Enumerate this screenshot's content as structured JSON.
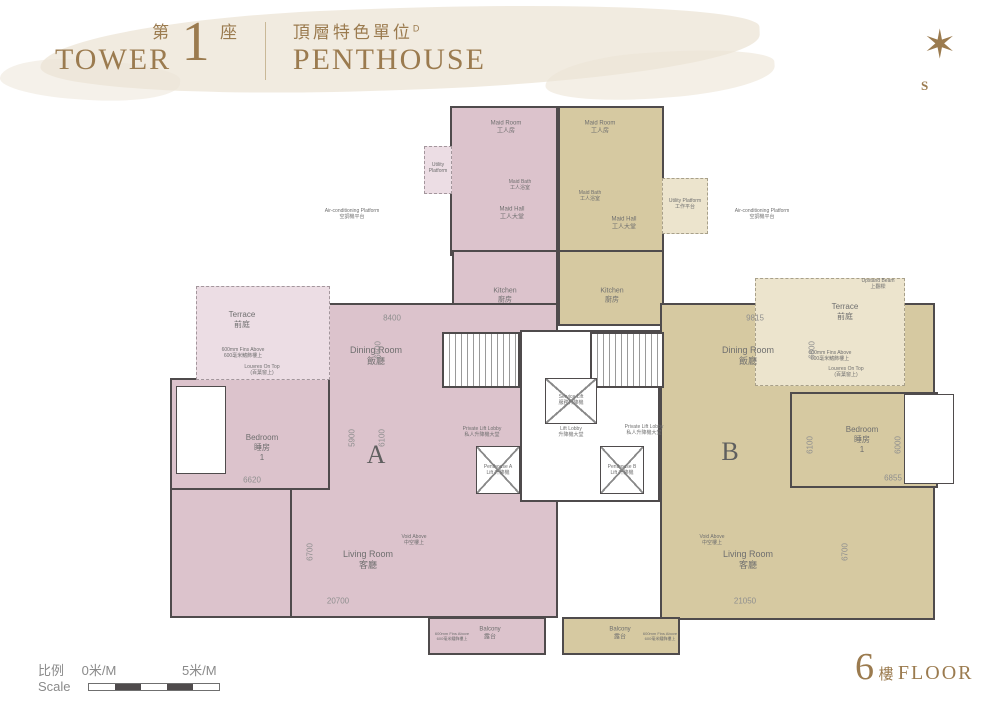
{
  "header": {
    "tower_zh_prefix": "第",
    "tower_number": "1",
    "tower_zh_suffix": "座",
    "tower_en": "TOWER",
    "unit_zh": "頂層特色單位",
    "unit_superscript": "D",
    "unit_en": "PENTHOUSE"
  },
  "compass": {
    "south_label": "S",
    "star_icon": "compass-star"
  },
  "footer": {
    "scale_zh": "比例",
    "scale_en": "Scale",
    "scale_start": "0米/M",
    "scale_end": "5米/M",
    "floor_number": "6",
    "floor_zh": "樓",
    "floor_en": "FLOOR"
  },
  "colors": {
    "accent_gold": "#9b7b4f",
    "unit_a_fill": "#dcc3cc",
    "unit_b_fill": "#d6c9a1",
    "wall": "#4f4b4c",
    "label_gray": "#6f6f6f",
    "dim_gray": "#8f8f8f"
  },
  "plan": {
    "rooms": [
      {
        "id": "unit-a-maid-block",
        "x": 450,
        "y": 106,
        "w": 108,
        "h": 150,
        "cls": "a"
      },
      {
        "id": "unit-a-utility-platform",
        "x": 424,
        "y": 146,
        "w": 28,
        "h": 48,
        "cls": "a-light"
      },
      {
        "id": "unit-a-kitchen",
        "x": 452,
        "y": 250,
        "w": 106,
        "h": 76,
        "cls": "a"
      },
      {
        "id": "unit-a-body",
        "x": 290,
        "y": 303,
        "w": 268,
        "h": 315,
        "cls": "a"
      },
      {
        "id": "unit-a-bedroom",
        "x": 170,
        "y": 378,
        "w": 160,
        "h": 112,
        "cls": "a"
      },
      {
        "id": "unit-a-left-wing",
        "x": 170,
        "y": 488,
        "w": 122,
        "h": 130,
        "cls": "a"
      },
      {
        "id": "unit-a-bath",
        "x": 176,
        "y": 386,
        "w": 50,
        "h": 88,
        "cls": "white thin"
      },
      {
        "id": "unit-a-terrace",
        "x": 196,
        "y": 286,
        "w": 134,
        "h": 94,
        "cls": "a-light"
      },
      {
        "id": "unit-a-balcony",
        "x": 428,
        "y": 617,
        "w": 118,
        "h": 38,
        "cls": "a"
      },
      {
        "id": "unit-b-maid-block",
        "x": 558,
        "y": 106,
        "w": 106,
        "h": 150,
        "cls": "b"
      },
      {
        "id": "unit-b-utility-platform",
        "x": 662,
        "y": 178,
        "w": 46,
        "h": 56,
        "cls": "b-light"
      },
      {
        "id": "unit-b-kitchen",
        "x": 558,
        "y": 250,
        "w": 106,
        "h": 76,
        "cls": "b"
      },
      {
        "id": "unit-b-body",
        "x": 660,
        "y": 303,
        "w": 275,
        "h": 317,
        "cls": "b"
      },
      {
        "id": "unit-b-bedroom",
        "x": 790,
        "y": 392,
        "w": 148,
        "h": 96,
        "cls": "b"
      },
      {
        "id": "unit-b-bath",
        "x": 904,
        "y": 394,
        "w": 50,
        "h": 90,
        "cls": "white thin"
      },
      {
        "id": "unit-b-terrace",
        "x": 755,
        "y": 278,
        "w": 150,
        "h": 108,
        "cls": "b-light"
      },
      {
        "id": "unit-b-balcony",
        "x": 562,
        "y": 617,
        "w": 118,
        "h": 38,
        "cls": "b"
      },
      {
        "id": "core-block",
        "x": 520,
        "y": 330,
        "w": 140,
        "h": 172,
        "cls": "core"
      },
      {
        "id": "stair-a",
        "x": 442,
        "y": 332,
        "w": 78,
        "h": 56,
        "cls": "stair"
      },
      {
        "id": "stair-b",
        "x": 590,
        "y": 332,
        "w": 74,
        "h": 56,
        "cls": "stair"
      },
      {
        "id": "service-lift-shaft",
        "x": 545,
        "y": 378,
        "w": 52,
        "h": 46,
        "cls": "lift"
      },
      {
        "id": "penthouse-a-lift-shaft",
        "x": 476,
        "y": 446,
        "w": 44,
        "h": 48,
        "cls": "lift"
      },
      {
        "id": "penthouse-b-lift-shaft",
        "x": 600,
        "y": 446,
        "w": 44,
        "h": 48,
        "cls": "lift"
      }
    ],
    "labels": [
      {
        "id": "maid-room-a-label",
        "en": "Maid Room",
        "zh": "工人房",
        "x": 506,
        "y": 128,
        "size": 6
      },
      {
        "id": "maid-hall-a-label",
        "en": "Maid Hall",
        "zh": "工人大堂",
        "x": 512,
        "y": 214,
        "size": 6
      },
      {
        "id": "maid-bath-a-label",
        "en": "Maid Bath",
        "zh": "工人浴室",
        "x": 520,
        "y": 185,
        "size": 5
      },
      {
        "id": "utility-platform-a-label",
        "en": "Utility",
        "zh": "Platform",
        "x": 438,
        "y": 168,
        "size": 5
      },
      {
        "id": "maid-room-b-label",
        "en": "Maid Room",
        "zh": "工人房",
        "x": 600,
        "y": 128,
        "size": 6
      },
      {
        "id": "maid-bath-b-label",
        "en": "Maid Bath",
        "zh": "工人浴室",
        "x": 590,
        "y": 196,
        "size": 5
      },
      {
        "id": "maid-hall-b-label",
        "en": "Maid Hall",
        "zh": "工人大堂",
        "x": 624,
        "y": 224,
        "size": 6
      },
      {
        "id": "utility-platform-b-label",
        "en": "Utility Platform",
        "zh": "工作平台",
        "x": 685,
        "y": 204,
        "size": 5
      },
      {
        "id": "kitchen-a-label",
        "en": "Kitchen",
        "zh": "廚房",
        "x": 505,
        "y": 296,
        "size": 7
      },
      {
        "id": "kitchen-b-label",
        "en": "Kitchen",
        "zh": "廚房",
        "x": 612,
        "y": 296,
        "size": 7
      },
      {
        "id": "dining-a-label",
        "en": "Dining Room",
        "zh": "飯廳",
        "x": 376,
        "y": 356,
        "size": 9
      },
      {
        "id": "dining-b-label",
        "en": "Dining Room",
        "zh": "飯廳",
        "x": 748,
        "y": 356,
        "size": 9
      },
      {
        "id": "unit-a-letter",
        "en": "A",
        "zh": "",
        "x": 376,
        "y": 455,
        "size": 26,
        "unit": true
      },
      {
        "id": "unit-b-letter",
        "en": "B",
        "zh": "",
        "x": 730,
        "y": 452,
        "size": 26,
        "unit": true
      },
      {
        "id": "living-a-label",
        "en": "Living Room",
        "zh": "客廳",
        "x": 368,
        "y": 560,
        "size": 9
      },
      {
        "id": "living-b-label",
        "en": "Living Room",
        "zh": "客廳",
        "x": 748,
        "y": 560,
        "size": 9
      },
      {
        "id": "bedroom-a-label",
        "en": "Bedroom",
        "zh": "睡房",
        "x": 262,
        "y": 448,
        "size": 8,
        "num": "1"
      },
      {
        "id": "bedroom-b-label",
        "en": "Bedroom",
        "zh": "睡房",
        "x": 862,
        "y": 440,
        "size": 8,
        "num": "1"
      },
      {
        "id": "terrace-a-label",
        "en": "Terrace",
        "zh": "前庭",
        "x": 242,
        "y": 320,
        "size": 8
      },
      {
        "id": "terrace-b-label",
        "en": "Terrace",
        "zh": "前庭",
        "x": 845,
        "y": 312,
        "size": 8
      },
      {
        "id": "balcony-a-label",
        "en": "Balcony",
        "zh": "露台",
        "x": 490,
        "y": 634,
        "size": 6
      },
      {
        "id": "balcony-b-label",
        "en": "Balcony",
        "zh": "露台",
        "x": 620,
        "y": 634,
        "size": 6
      },
      {
        "id": "service-lift-label",
        "en": "Service Lift",
        "zh": "服務升降機",
        "x": 571,
        "y": 400,
        "size": 5
      },
      {
        "id": "lift-lobby-label",
        "en": "Lift Lobby",
        "zh": "升降機大堂",
        "x": 571,
        "y": 432,
        "size": 5
      },
      {
        "id": "private-lift-lobby-a-label",
        "en": "Private Lift Lobby",
        "zh": "私人升降機大堂",
        "x": 482,
        "y": 432,
        "size": 5
      },
      {
        "id": "private-lift-lobby-b-label",
        "en": "Private Lift Lobby",
        "zh": "私人升降機大堂",
        "x": 644,
        "y": 430,
        "size": 5
      },
      {
        "id": "penthouse-a-lift-label",
        "en": "Penthouse A",
        "zh": "Lift 升降機",
        "x": 498,
        "y": 470,
        "size": 5
      },
      {
        "id": "penthouse-b-lift-label",
        "en": "Penthouse B",
        "zh": "Lift 升降機",
        "x": 622,
        "y": 470,
        "size": 5
      },
      {
        "id": "ac-platform-left-label",
        "en": "Air-conditioning Platform",
        "zh": "空調機平台",
        "x": 352,
        "y": 214,
        "size": 5
      },
      {
        "id": "ac-platform-right-label",
        "en": "Air-conditioning Platform",
        "zh": "空調機平台",
        "x": 762,
        "y": 214,
        "size": 5
      },
      {
        "id": "void-above-a-label",
        "en": "Void Above",
        "zh": "中空樓上",
        "x": 414,
        "y": 540,
        "size": 5
      },
      {
        "id": "void-above-b-label",
        "en": "Void Above",
        "zh": "中空樓上",
        "x": 712,
        "y": 540,
        "size": 5
      },
      {
        "id": "fins-above-terrace-a-label",
        "en": "600mm Fins Above",
        "zh": "600毫米鰭飾樓上",
        "x": 243,
        "y": 353,
        "size": 5
      },
      {
        "id": "louvre-terrace-a-label",
        "en": "Louvres On Top",
        "zh": "(百葉窗上)",
        "x": 262,
        "y": 370,
        "size": 5
      },
      {
        "id": "fins-above-terrace-b-label",
        "en": "600mm Fins Above",
        "zh": "600毫米鰭飾樓上",
        "x": 830,
        "y": 356,
        "size": 5
      },
      {
        "id": "louvre-terrace-b-label",
        "en": "Louvres On Top",
        "zh": "(百葉窗上)",
        "x": 846,
        "y": 372,
        "size": 5
      },
      {
        "id": "upstand-beam-b-label",
        "en": "Upstand Beam",
        "zh": "上翻樑",
        "x": 878,
        "y": 284,
        "size": 5
      },
      {
        "id": "fins-balcony-a-label",
        "en": "600mm Fins Above",
        "zh": "600毫米鰭飾樓上",
        "x": 452,
        "y": 636,
        "size": 4
      },
      {
        "id": "fins-balcony-b-label",
        "en": "600mm Fins Above",
        "zh": "600毫米鰭飾樓上",
        "x": 660,
        "y": 636,
        "size": 4
      }
    ],
    "dims": [
      {
        "t": "8400",
        "x": 392,
        "y": 318,
        "rot": 0
      },
      {
        "t": "6600",
        "x": 378,
        "y": 350,
        "rot": 90
      },
      {
        "t": "5900",
        "x": 352,
        "y": 438,
        "rot": 90
      },
      {
        "t": "6100",
        "x": 382,
        "y": 438,
        "rot": 90
      },
      {
        "t": "6620",
        "x": 252,
        "y": 480,
        "rot": 0
      },
      {
        "t": "6700",
        "x": 310,
        "y": 552,
        "rot": 90
      },
      {
        "t": "20700",
        "x": 338,
        "y": 601,
        "rot": 0
      },
      {
        "t": "9815",
        "x": 755,
        "y": 318,
        "rot": 0
      },
      {
        "t": "6600",
        "x": 812,
        "y": 350,
        "rot": 90
      },
      {
        "t": "6100",
        "x": 810,
        "y": 445,
        "rot": 90
      },
      {
        "t": "6000",
        "x": 898,
        "y": 445,
        "rot": 90
      },
      {
        "t": "6855",
        "x": 893,
        "y": 478,
        "rot": 0
      },
      {
        "t": "6700",
        "x": 845,
        "y": 552,
        "rot": 90
      },
      {
        "t": "21050",
        "x": 745,
        "y": 601,
        "rot": 0
      }
    ]
  }
}
